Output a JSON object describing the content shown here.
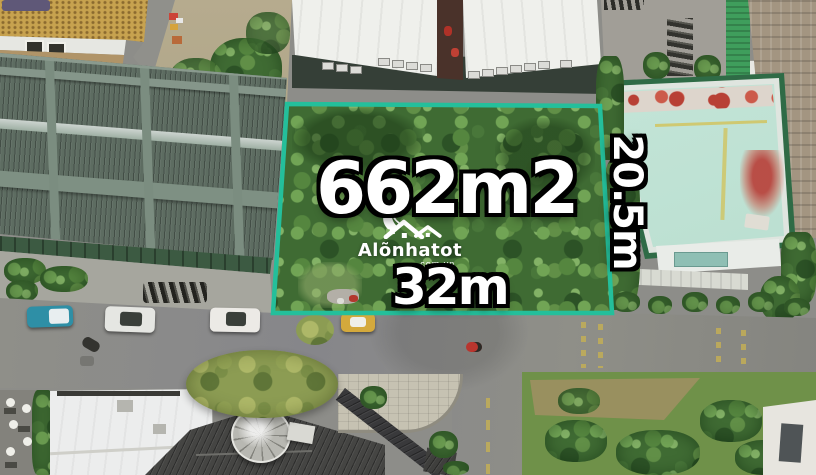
{
  "annotations": {
    "area_label": "662m2",
    "frontage_label": "32m",
    "side_label": "20.5m"
  },
  "watermark": {
    "brand": "Alõnhatot",
    "suffix": ".com.vn",
    "icon": "house-leaf-logo-icon"
  },
  "colors": {
    "boundary": "#24bf9b",
    "label_fill": "#ffffff",
    "label_outline": "#000000"
  }
}
